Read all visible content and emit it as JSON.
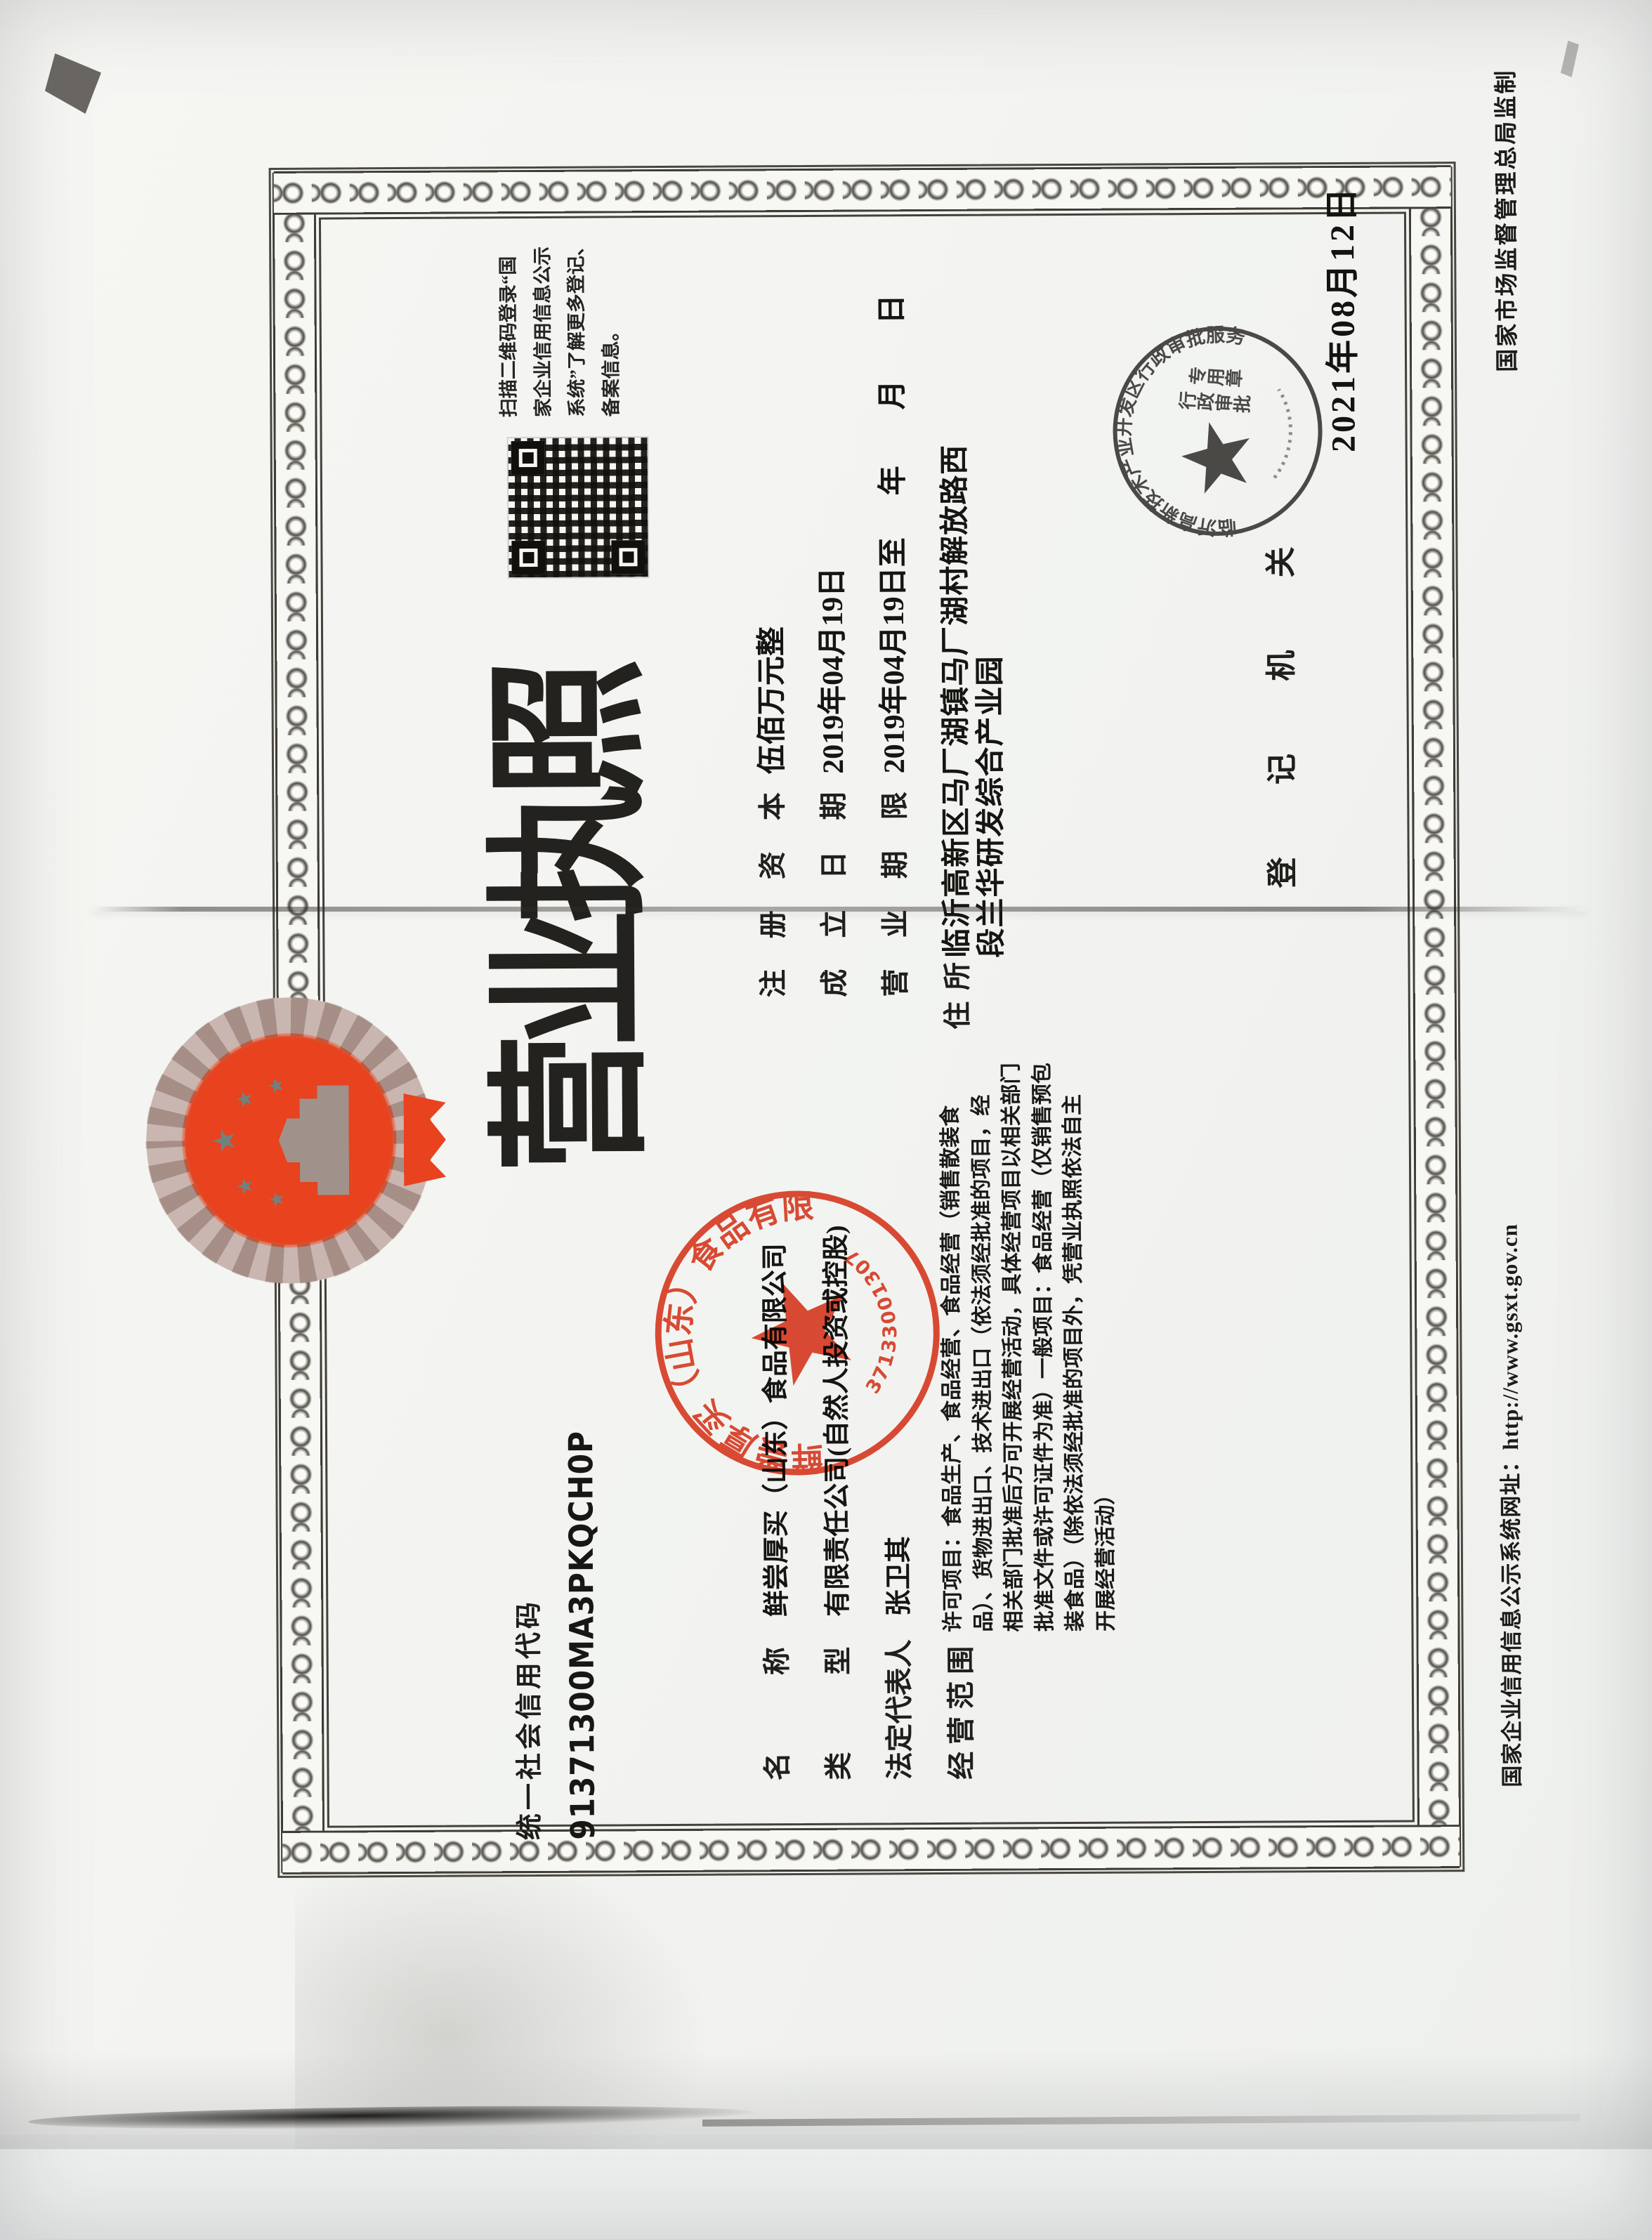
{
  "document": {
    "credit_code_label": "统一社会信用代码",
    "credit_code": "91371300MA3PKQCH0P",
    "title_chars": [
      "营",
      "业",
      "执",
      "照"
    ],
    "qr_note_lines": [
      "扫描二维码登录“国",
      "家企业信用信息公示",
      "系统”了解更多登记、",
      "备案信息。"
    ],
    "fields": {
      "name_label": "名称",
      "name_value": "鲜尝厚买（山东）食品有限公司",
      "type_label": "类型",
      "type_value": "有限责任公司(自然人投资或控股)",
      "legal_rep_label": "法定代表人",
      "legal_rep_value": "张卫其",
      "scope_label": "经营范围",
      "scope_lines": [
        "许可项目：食品生产、食品经营、食品经营（销售散装食",
        "品）、货物进出口、技术进出口（依法须经批准的项目，经",
        "相关部门批准后方可开展经营活动，具体经营项目以相关部门",
        "批准文件或许可证件为准）一般项目：食品经营（仅销售预包",
        "装食品）（除依法须经批准的项目外，凭营业执照依法自主",
        "开展经营活动）"
      ],
      "capital_label": "注册资本",
      "capital_value": "伍佰万元整",
      "established_label": "成立日期",
      "established_value": "2019年04月19日",
      "term_label": "营业期限",
      "term_value": "2019年04月19日至",
      "term_blank_year": "年",
      "term_blank_month": "月",
      "term_blank_day": "日",
      "address_label": "住所",
      "address_line1": "临沂高新区马厂湖镇马厂湖村解放路西",
      "address_line2": "段兰华研发综合产业园"
    },
    "registration": {
      "authority_label": "登记机关",
      "date": "2021年08月12日"
    },
    "company_seal": {
      "ring_text": "鲜尝厚买（山东）食品有限公司",
      "serial": "3713300130705",
      "color": "#d63a22"
    },
    "authority_stamp": {
      "ring_text": "临沂高新技术产业开发区行政审批服务局",
      "center_col_right": "行政审批",
      "center_col_left": "专用章",
      "color": "#33312d"
    },
    "margins": {
      "publicity_url": "国家企业信用信息公示系统网址：http://www.gsxt.gov.cn",
      "producer": "国家市场监督管理总局监制"
    }
  }
}
